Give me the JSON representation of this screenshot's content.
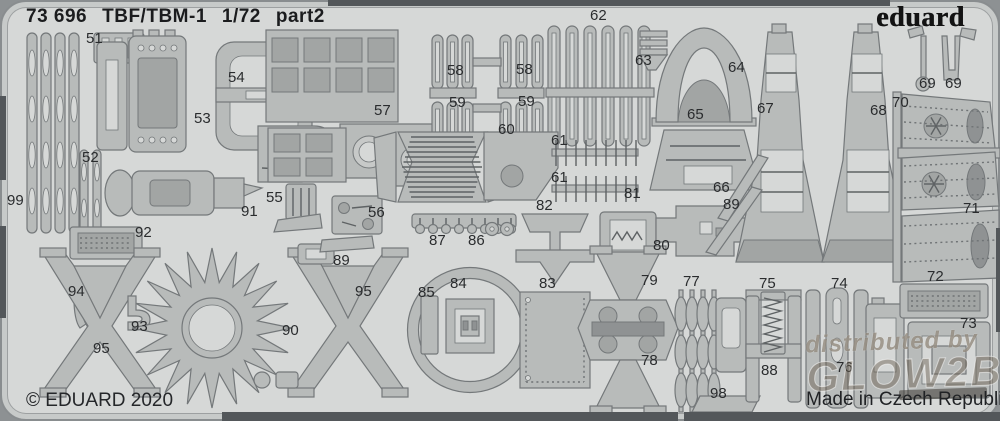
{
  "header": {
    "code": "73 696",
    "kit": "TBF/TBM-1",
    "scale": "1/72",
    "part": "part2"
  },
  "brand": {
    "logo": "eduard"
  },
  "footer": {
    "copyright": "© EDUARD 2020",
    "origin": "Made in Czech Republic"
  },
  "watermark": {
    "line1": "distributed by",
    "line2": "GLOW2B"
  },
  "colors": {
    "scene": "#8d9193",
    "sheet": "#d6d8d7",
    "part": "#b8bbba",
    "part_dark": "#a2a5a4",
    "outline": "#74787a",
    "edge_dark": "#53575a",
    "label_text": "#2a2c2e",
    "title_text": "#1b1c1e"
  },
  "part_labels": [
    {
      "t": "51",
      "x": 86,
      "y": 31
    },
    {
      "t": "54",
      "x": 228,
      "y": 70
    },
    {
      "t": "53",
      "x": 194,
      "y": 111
    },
    {
      "t": "52",
      "x": 82,
      "y": 150
    },
    {
      "t": "99",
      "x": 7,
      "y": 193
    },
    {
      "t": "91",
      "x": 241,
      "y": 204
    },
    {
      "t": "92",
      "x": 135,
      "y": 225
    },
    {
      "t": "55",
      "x": 266,
      "y": 190
    },
    {
      "t": "56",
      "x": 368,
      "y": 205
    },
    {
      "t": "94",
      "x": 68,
      "y": 284
    },
    {
      "t": "93",
      "x": 131,
      "y": 319
    },
    {
      "t": "95",
      "x": 93,
      "y": 341
    },
    {
      "t": "90",
      "x": 282,
      "y": 323
    },
    {
      "t": "89",
      "x": 333,
      "y": 253
    },
    {
      "t": "95",
      "x": 355,
      "y": 284
    },
    {
      "t": "57",
      "x": 374,
      "y": 103
    },
    {
      "t": "58",
      "x": 447,
      "y": 63
    },
    {
      "t": "59",
      "x": 449,
      "y": 95
    },
    {
      "t": "58",
      "x": 516,
      "y": 62
    },
    {
      "t": "59",
      "x": 518,
      "y": 94
    },
    {
      "t": "60",
      "x": 498,
      "y": 122
    },
    {
      "t": "61",
      "x": 551,
      "y": 133
    },
    {
      "t": "61",
      "x": 551,
      "y": 170
    },
    {
      "t": "62",
      "x": 590,
      "y": 8
    },
    {
      "t": "63",
      "x": 635,
      "y": 53
    },
    {
      "t": "64",
      "x": 728,
      "y": 60
    },
    {
      "t": "65",
      "x": 687,
      "y": 107
    },
    {
      "t": "66",
      "x": 713,
      "y": 180
    },
    {
      "t": "89",
      "x": 723,
      "y": 197
    },
    {
      "t": "67",
      "x": 757,
      "y": 101
    },
    {
      "t": "68",
      "x": 870,
      "y": 103
    },
    {
      "t": "70",
      "x": 892,
      "y": 95
    },
    {
      "t": "69",
      "x": 919,
      "y": 76
    },
    {
      "t": "69",
      "x": 945,
      "y": 76
    },
    {
      "t": "71",
      "x": 963,
      "y": 201
    },
    {
      "t": "72",
      "x": 927,
      "y": 269
    },
    {
      "t": "73",
      "x": 960,
      "y": 316
    },
    {
      "t": "74",
      "x": 831,
      "y": 276
    },
    {
      "t": "75",
      "x": 759,
      "y": 276
    },
    {
      "t": "76",
      "x": 836,
      "y": 360
    },
    {
      "t": "77",
      "x": 683,
      "y": 274
    },
    {
      "t": "78",
      "x": 641,
      "y": 353
    },
    {
      "t": "79",
      "x": 641,
      "y": 273
    },
    {
      "t": "80",
      "x": 653,
      "y": 238
    },
    {
      "t": "81",
      "x": 624,
      "y": 186
    },
    {
      "t": "82",
      "x": 536,
      "y": 198
    },
    {
      "t": "83",
      "x": 539,
      "y": 276
    },
    {
      "t": "84",
      "x": 450,
      "y": 276
    },
    {
      "t": "85",
      "x": 418,
      "y": 285
    },
    {
      "t": "86",
      "x": 468,
      "y": 233
    },
    {
      "t": "87",
      "x": 429,
      "y": 233
    },
    {
      "t": "88",
      "x": 761,
      "y": 363
    },
    {
      "t": "98",
      "x": 710,
      "y": 386
    }
  ]
}
